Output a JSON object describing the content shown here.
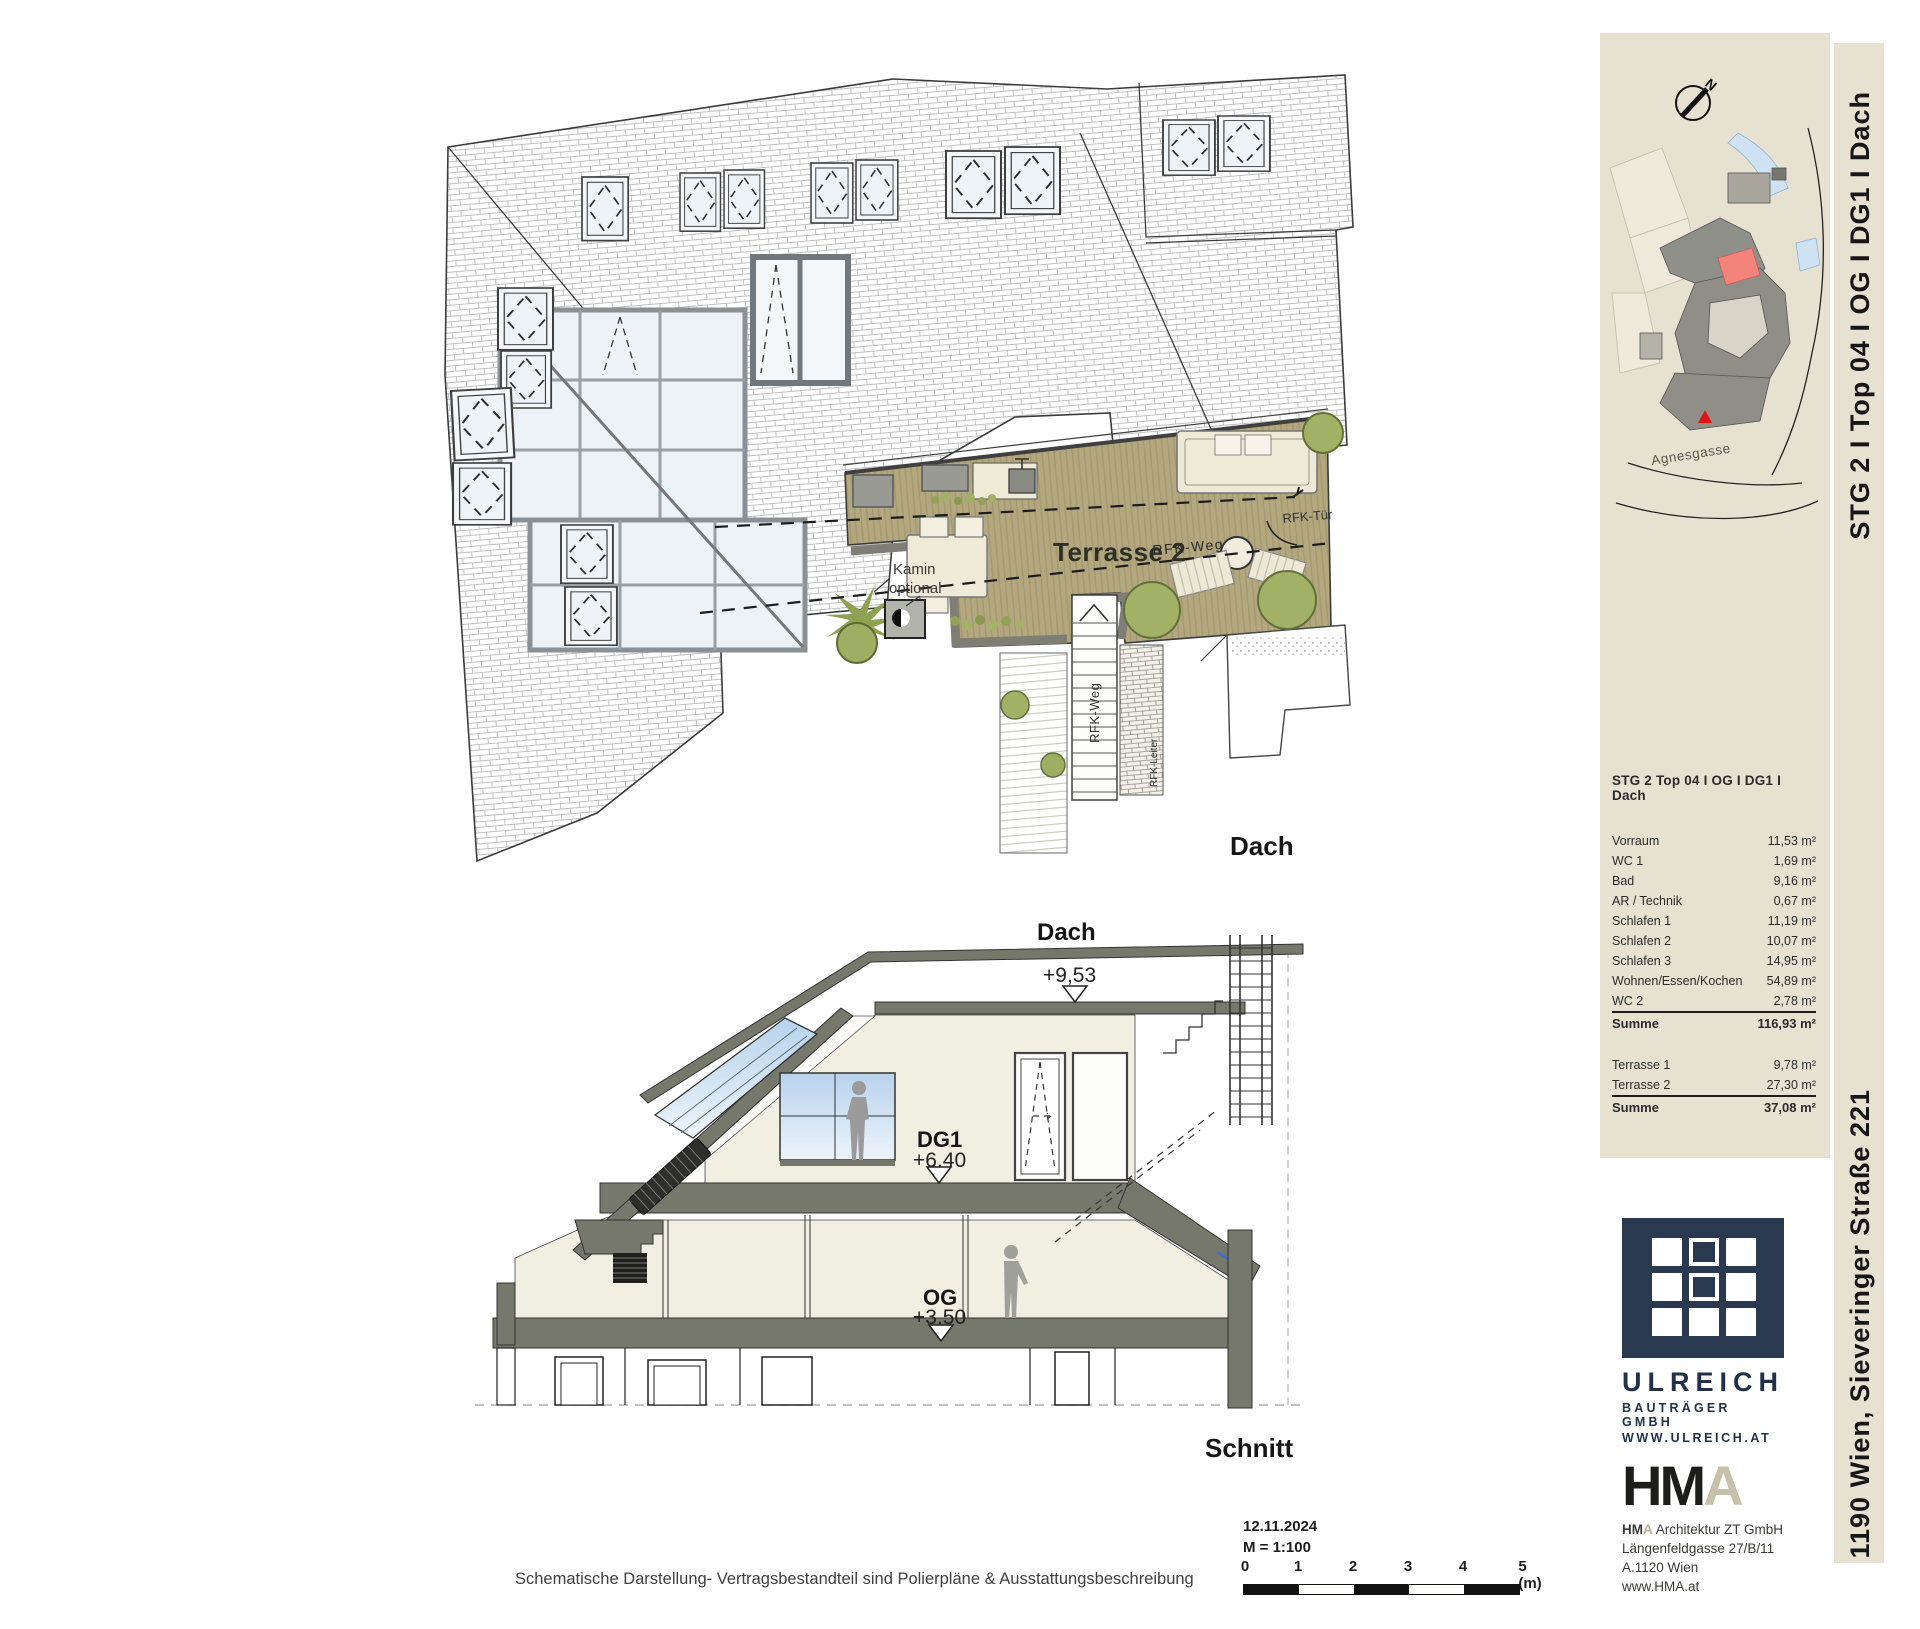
{
  "plan": {
    "title": "Dach",
    "terrace_label": "Terrasse 2",
    "kamin_line1": "Kamin",
    "kamin_line2": "optional",
    "rfk_weg": "RFK-Weg",
    "rfk_weg_vertical": "RFK-Weg",
    "rfk_tuer": "RFK-Tür",
    "rfk_leiter": "RFK-Leiter"
  },
  "section": {
    "title": "Schnitt",
    "levels": [
      {
        "name": "Dach",
        "elevation": "+9,53"
      },
      {
        "name": "DG1",
        "elevation": "+6,40"
      },
      {
        "name": "OG",
        "elevation": "+3,50"
      }
    ]
  },
  "sidebar": {
    "site_map": {
      "north_label": "N",
      "street_label": "Agnesgasse"
    },
    "unit_table": {
      "title": "STG 2 Top 04  I OG I DG1 I Dach",
      "rows": [
        {
          "label": "Vorraum",
          "value": "11,53 m²"
        },
        {
          "label": "WC 1",
          "value": "1,69 m²"
        },
        {
          "label": "Bad",
          "value": "9,16 m²"
        },
        {
          "label": "AR / Technik",
          "value": "0,67 m²"
        },
        {
          "label": "Schlafen 1",
          "value": "11,19 m²"
        },
        {
          "label": "Schlafen 2",
          "value": "10,07 m²"
        },
        {
          "label": "Schlafen 3",
          "value": "14,95 m²"
        },
        {
          "label": "Wohnen/Essen/Kochen",
          "value": "54,89 m²"
        },
        {
          "label": "WC 2",
          "value": "2,78 m²"
        }
      ],
      "sum_row": {
        "label": "Summe",
        "value": "116,93 m²"
      },
      "terrace_rows": [
        {
          "label": "Terrasse 1",
          "value": "9,78 m²"
        },
        {
          "label": "Terrasse 2",
          "value": "27,30 m²"
        }
      ],
      "terrace_sum": {
        "label": "Summe",
        "value": "37,08 m²"
      }
    },
    "ulreich": {
      "name": "ULREICH",
      "line2": "BAUTRÄGER GMBH",
      "line3": "WWW.ULREICH.AT"
    },
    "hma": {
      "logo_hm": "HM",
      "logo_a": "A",
      "line1_hm": "HM",
      "line1_a": "A",
      "line1_rest": " Architektur ZT GmbH",
      "line2": "Längenfeldgasse 27/B/11",
      "line3": "A.1120 Wien",
      "line4": "www.HMA.at"
    }
  },
  "edge_labels": {
    "top": "STG 2  I  Top 04 I OG I DG1 I Dach",
    "bottom": "1190 Wien, Sieveringer Straße 221"
  },
  "footer": {
    "disclaimer": "Schematische Darstellung- Vertragsbestandteil sind Polierpläne & Ausstattungsbeschreibung",
    "date": "12.11.2024",
    "scale": "M = 1:100",
    "scale_ticks": [
      "0",
      "1",
      "2",
      "3",
      "4",
      "5 (m)"
    ]
  },
  "colors": {
    "panel_beige": "#e7e1d2",
    "deck_tan": "#b2a77e",
    "tree_olive": "#a3b166",
    "slab_gray": "#75786a",
    "navy": "#2b3950",
    "hma_tan": "#c6c0a9",
    "unit_red": "#f4837b",
    "marker_red": "#e11414",
    "sky_blue": "#bcd4ee"
  }
}
